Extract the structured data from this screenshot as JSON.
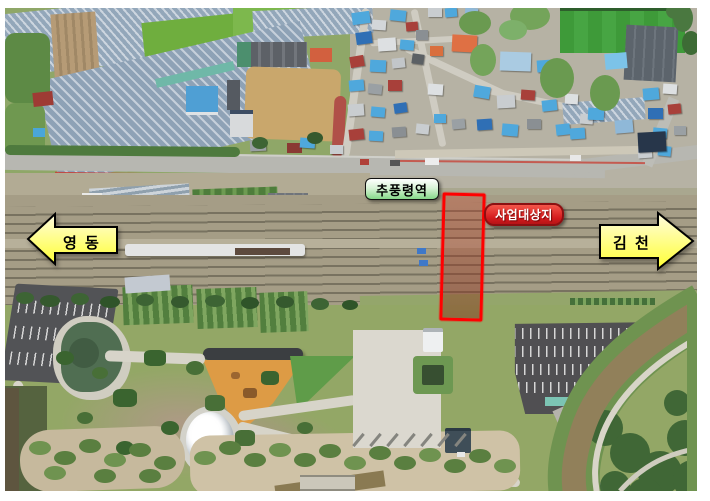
{
  "map": {
    "type": "aerial-photograph-site-map",
    "station_label": "추풍령역",
    "site_label": "사업대상지",
    "left_direction": "영 동",
    "right_direction": "김 천",
    "colors": {
      "site_outline": "#ff0000",
      "site_fill": "rgba(214,60,34,0.38)",
      "station_label_top": "#ffffff",
      "station_label_bottom": "#86d989",
      "site_label_bg": "#d31a1d",
      "site_label_border": "#8c1012",
      "direction_arrow_fill": "#ffff33",
      "direction_arrow_fill_light": "#fffce0",
      "direction_arrow_border": "#000000"
    }
  }
}
